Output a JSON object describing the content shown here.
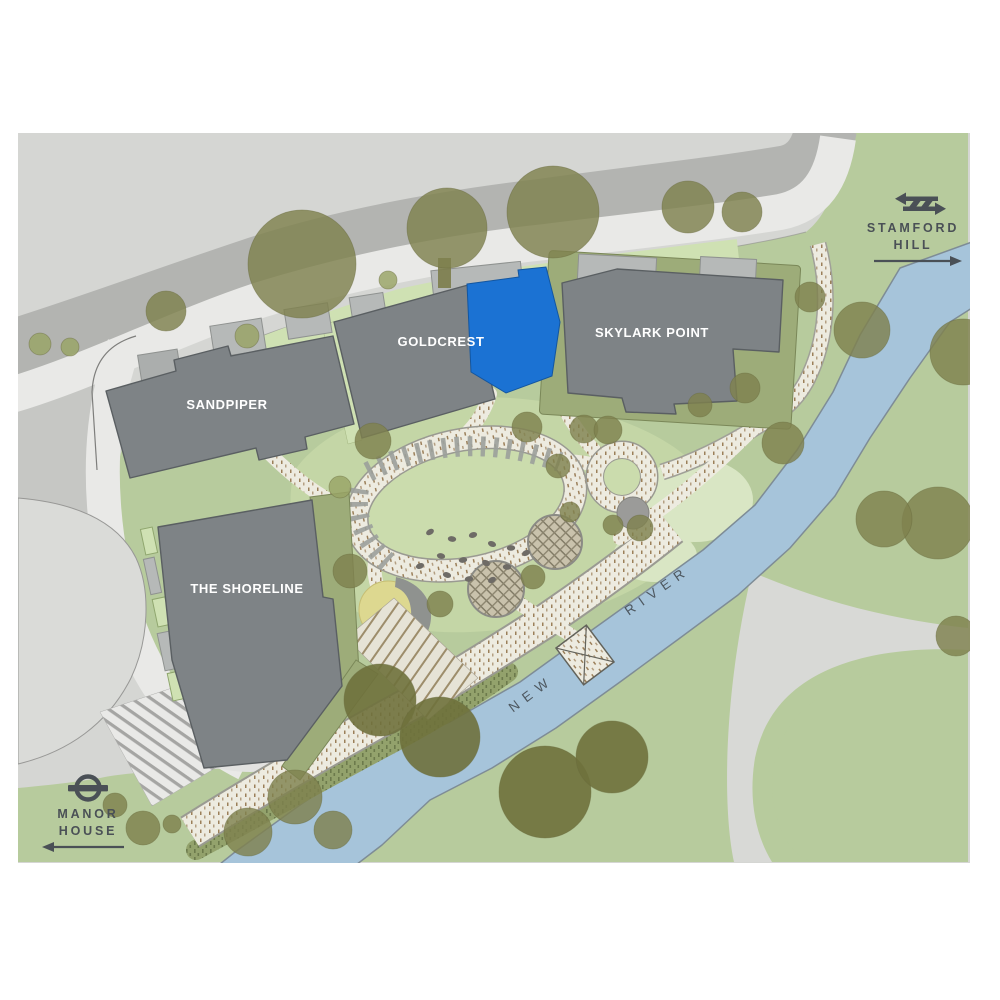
{
  "map": {
    "buildings": [
      {
        "id": "sandpiper",
        "label": "SANDPIPER"
      },
      {
        "id": "goldcrest",
        "label": "GOLDCREST"
      },
      {
        "id": "skylark-point",
        "label": "SKYLARK POINT"
      },
      {
        "id": "the-shoreline",
        "label": "THE SHORELINE"
      }
    ],
    "highlighted_plot": {
      "color": "#1b72d3"
    },
    "river": {
      "words": [
        "NEW",
        "RIVER"
      ]
    },
    "stations": [
      {
        "id": "stamford-hill",
        "lines": [
          "STAMFORD",
          "HILL"
        ],
        "icon": "national-rail-icon",
        "arrow_direction": "right"
      },
      {
        "id": "manor-house",
        "lines": [
          "MANOR",
          "HOUSE"
        ],
        "icon": "london-underground-roundel-icon",
        "arrow_direction": "left"
      }
    ],
    "colors": {
      "background": "#ffffff",
      "road_light": "#d5d6d3",
      "road_mid": "#b3b4b1",
      "pavement": "#e9e9e7",
      "green_main": "#b7cb9d",
      "green_light_strip": "#cfe1b3",
      "green_pale": "#d9e6c4",
      "lawn": "#cbdcad",
      "olive_band": "#9dac79",
      "building_gray": "#7e8386",
      "building_outline": "#5a5f62",
      "podium_gray": "#b6b9b8",
      "highlight_blue": "#1b72d3",
      "river_blue": "#a6c4da",
      "path_cream": "#edebe0",
      "path_speck_brown": "#8d6c42",
      "tree_olive": "#7f814e",
      "sand_yellow": "#ddd890",
      "label_dark": "#4a5056",
      "label_white": "#ffffff"
    }
  }
}
